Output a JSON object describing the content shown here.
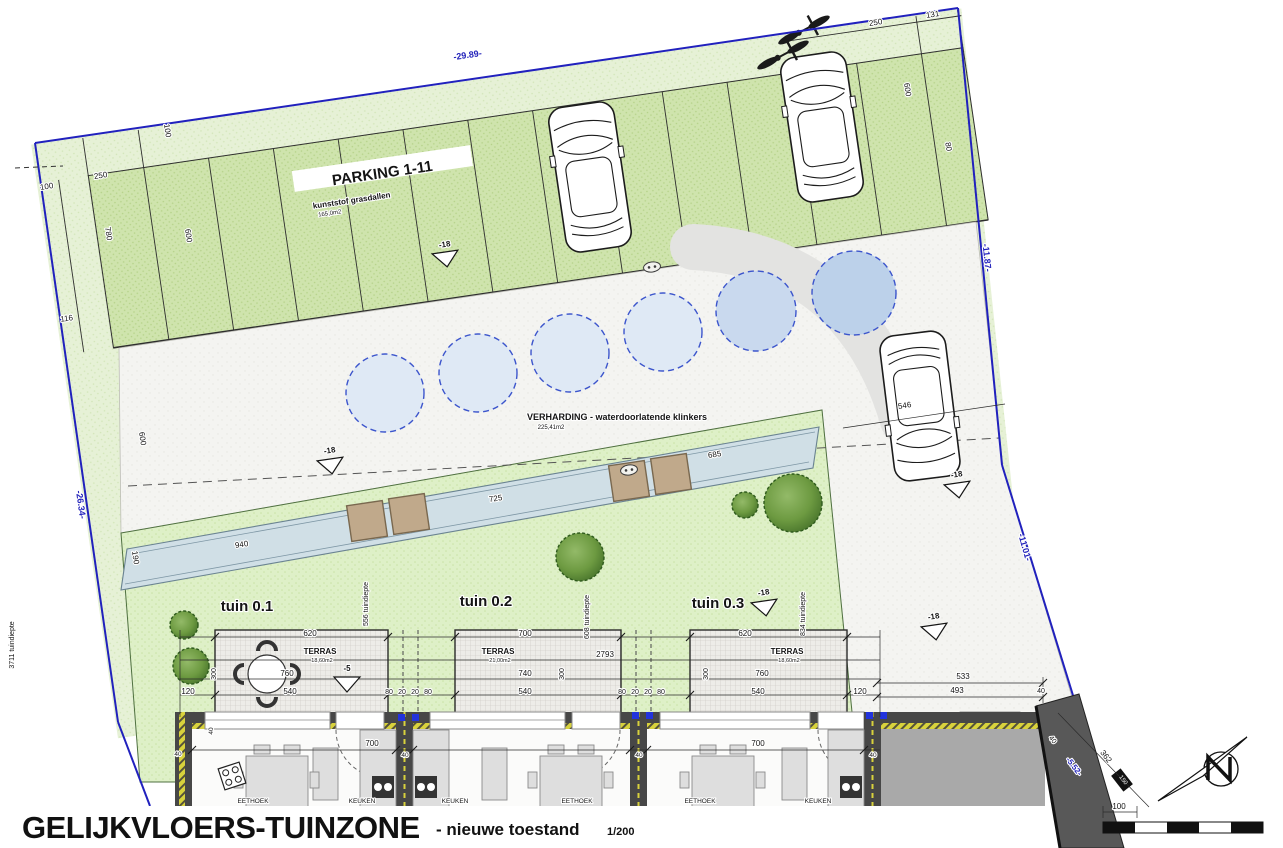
{
  "meta": {
    "drawing_title": "GELIJKVLOERS-TUINZONE",
    "subtitle": "- nieuwe toestand",
    "scale": "1/200"
  },
  "site": {
    "parking": {
      "label": "PARKING 1-11",
      "material": "kunststof grasdallen",
      "area": "165,0m2",
      "stalls": 11
    },
    "paving": {
      "label": "VERHARDING - waterdoorlatende klinkers",
      "area": "225,41m2"
    },
    "gardens": [
      {
        "name": "tuin 0.1",
        "terrace_label": "TERRAS",
        "terrace_area": "18,60m2",
        "depth_label": "556 tuindiepte"
      },
      {
        "name": "tuin 0.2",
        "terrace_label": "TERRAS",
        "terrace_area": "21,00m2",
        "depth_label": "608 tuindiepte"
      },
      {
        "name": "tuin 0.3",
        "terrace_label": "TERRAS",
        "terrace_area": "18,60m2",
        "depth_label": "834 tuindiepte"
      }
    ],
    "left_depth_label": "3711 tuindiepte",
    "boundary_lengths": [
      "-29.89-",
      "-11.87-",
      "-11.01-",
      "-26.34-",
      "-5.52-"
    ],
    "level_markers": [
      "-18",
      "-5"
    ],
    "rooms": [
      "EETHOEK",
      "KEUKEN",
      "KEUKEN",
      "EETHOEK",
      "EETHOEK",
      "KEUKEN"
    ]
  },
  "colors": {
    "boundary_blue": "#2121bd",
    "band_green": "#e6f1d6",
    "parking_green": "#cfe4ad",
    "garden_green": "#def0c7",
    "paving_grey": "#f4f4f1",
    "channel_blue": "#d0dfe6",
    "circle_light_blue": "#dfe9f5",
    "circle_dark_blue": "#bcd1ea",
    "bridge_tan": "#c0a98b",
    "wall_grey": "#474747",
    "insulation_yellow": "#d8d23c"
  },
  "annotations": [
    {
      "t": "-29.89-",
      "x": 468,
      "y": 58,
      "r": -8.3,
      "s": 9,
      "c": "#2323bb",
      "b": 1,
      "n": "boundary-length-label"
    },
    {
      "t": "-11.87-",
      "x": 984,
      "y": 258,
      "r": 84,
      "s": 9,
      "c": "#2323bb",
      "b": 1,
      "n": "boundary-length-label"
    },
    {
      "t": "-11.01-",
      "x": 1022,
      "y": 548,
      "r": 74,
      "s": 9,
      "c": "#2323bb",
      "b": 1,
      "n": "boundary-length-label"
    },
    {
      "t": "-26.34-",
      "x": 78,
      "y": 505,
      "r": 82,
      "s": 9,
      "c": "#2323bb",
      "b": 1,
      "n": "boundary-length-label"
    },
    {
      "t": "-5.52-",
      "x": 1072,
      "y": 768,
      "r": 52,
      "s": 8,
      "c": "#2323bb",
      "b": 1,
      "n": "boundary-length-label"
    },
    {
      "t": "250",
      "x": 876,
      "y": 25,
      "r": -8.3,
      "s": 8,
      "n": "dim-label"
    },
    {
      "t": "131",
      "x": 933,
      "y": 17,
      "r": -8.3,
      "s": 8,
      "n": "dim-label"
    },
    {
      "t": "600",
      "x": 905,
      "y": 90,
      "r": 81,
      "s": 8,
      "n": "dim-label"
    },
    {
      "t": "80",
      "x": 946,
      "y": 147,
      "r": 81,
      "s": 8,
      "n": "dim-label"
    },
    {
      "t": "100",
      "x": 165,
      "y": 131,
      "r": 81,
      "s": 8,
      "n": "dim-label"
    },
    {
      "t": "100",
      "x": 47,
      "y": 189,
      "r": -8.3,
      "s": 8,
      "n": "dim-label"
    },
    {
      "t": "250",
      "x": 101,
      "y": 178,
      "r": -8.3,
      "s": 8,
      "n": "dim-label"
    },
    {
      "t": "780",
      "x": 106,
      "y": 234,
      "r": 81,
      "s": 8,
      "n": "dim-label"
    },
    {
      "t": "600",
      "x": 186,
      "y": 236,
      "r": 81,
      "s": 8,
      "n": "dim-label"
    },
    {
      "t": "116",
      "x": 67,
      "y": 321,
      "r": -8.3,
      "s": 8,
      "n": "dim-label"
    },
    {
      "t": "600",
      "x": 140,
      "y": 439,
      "r": 81,
      "s": 8,
      "n": "dim-label"
    },
    {
      "t": "190",
      "x": 133,
      "y": 558,
      "r": 81,
      "s": 8,
      "n": "dim-label"
    },
    {
      "t": "940",
      "x": 242,
      "y": 547,
      "r": -8.3,
      "s": 8,
      "n": "dim-label"
    },
    {
      "t": "725",
      "x": 496,
      "y": 501,
      "r": -8.3,
      "s": 8,
      "n": "dim-label"
    },
    {
      "t": "685",
      "x": 715,
      "y": 457,
      "r": -8.3,
      "s": 8,
      "n": "dim-label"
    },
    {
      "t": "546",
      "x": 905,
      "y": 408,
      "r": -8.3,
      "s": 8,
      "n": "dim-label"
    },
    {
      "t": "PARKING 1-11",
      "x": 383,
      "y": 178,
      "r": -8.3,
      "s": 15,
      "b": 1,
      "n": "parking-label"
    },
    {
      "t": "kunststof grasdallen",
      "x": 352,
      "y": 203,
      "r": -8.3,
      "s": 8,
      "b": 1,
      "n": "parking-material-label"
    },
    {
      "t": "165,0m2",
      "x": 330,
      "y": 215,
      "r": -8.3,
      "s": 6,
      "n": "parking-area-label"
    },
    {
      "t": "VERHARDING - waterdoorlatende klinkers",
      "x": 617,
      "y": 420,
      "r": 0,
      "s": 9,
      "b": 1,
      "n": "paving-label"
    },
    {
      "t": "225,41m2",
      "x": 551,
      "y": 429,
      "r": 0,
      "s": 6,
      "n": "paving-area-label"
    },
    {
      "t": "-18",
      "x": 445,
      "y": 247,
      "r": -8.3,
      "s": 8,
      "b": 1,
      "n": "level-label"
    },
    {
      "t": "-18",
      "x": 330,
      "y": 453,
      "r": -8.3,
      "s": 8,
      "b": 1,
      "n": "level-label"
    },
    {
      "t": "-18",
      "x": 957,
      "y": 477,
      "r": -8.3,
      "s": 8,
      "b": 1,
      "n": "level-label"
    },
    {
      "t": "-18",
      "x": 764,
      "y": 595,
      "r": -8.3,
      "s": 8,
      "b": 1,
      "n": "level-label"
    },
    {
      "t": "-18",
      "x": 934,
      "y": 619,
      "r": -8.3,
      "s": 8,
      "b": 1,
      "n": "level-label"
    },
    {
      "t": "-5",
      "x": 347,
      "y": 671,
      "r": 0,
      "s": 8,
      "b": 1,
      "n": "level-label"
    },
    {
      "t": "tuin 0.1",
      "x": 247,
      "y": 611,
      "r": 0,
      "s": 15,
      "b": 1,
      "n": "garden-name"
    },
    {
      "t": "tuin 0.2",
      "x": 486,
      "y": 606,
      "r": 0,
      "s": 15,
      "b": 1,
      "n": "garden-name"
    },
    {
      "t": "tuin 0.3",
      "x": 718,
      "y": 608,
      "r": 0,
      "s": 15,
      "b": 1,
      "n": "garden-name"
    },
    {
      "t": "TERRAS",
      "x": 320,
      "y": 654,
      "r": 0,
      "s": 8,
      "b": 1,
      "n": "terrace-label"
    },
    {
      "t": "18,60m2",
      "x": 322,
      "y": 662,
      "r": 0,
      "s": 5.5,
      "n": "terrace-area-label"
    },
    {
      "t": "TERRAS",
      "x": 498,
      "y": 654,
      "r": 0,
      "s": 8,
      "b": 1,
      "n": "terrace-label"
    },
    {
      "t": "21,00m2",
      "x": 500,
      "y": 662,
      "r": 0,
      "s": 5.5,
      "n": "terrace-area-label"
    },
    {
      "t": "TERRAS",
      "x": 787,
      "y": 654,
      "r": 0,
      "s": 8,
      "b": 1,
      "n": "terrace-label"
    },
    {
      "t": "18,60m2",
      "x": 789,
      "y": 662,
      "r": 0,
      "s": 5.5,
      "n": "terrace-area-label"
    },
    {
      "t": "3711 tuindiepte",
      "x": 14,
      "y": 645,
      "r": -90,
      "s": 7,
      "n": "garden-depth-label"
    },
    {
      "t": "556 tuindiepte",
      "x": 368,
      "y": 604,
      "r": -90,
      "s": 7,
      "n": "garden-depth-label"
    },
    {
      "t": "608 tuindiepte",
      "x": 589,
      "y": 617,
      "r": -90,
      "s": 7,
      "n": "garden-depth-label"
    },
    {
      "t": "834 tuindiepte",
      "x": 805,
      "y": 614,
      "r": -90,
      "s": 7,
      "n": "garden-depth-label"
    },
    {
      "t": "620",
      "x": 310,
      "y": 636,
      "n": "dim-label"
    },
    {
      "t": "700",
      "x": 525,
      "y": 636,
      "n": "dim-label"
    },
    {
      "t": "620",
      "x": 745,
      "y": 636,
      "n": "dim-label"
    },
    {
      "t": "760",
      "x": 287,
      "y": 676,
      "n": "dim-label"
    },
    {
      "t": "740",
      "x": 525,
      "y": 676,
      "n": "dim-label"
    },
    {
      "t": "760",
      "x": 762,
      "y": 676,
      "n": "dim-label"
    },
    {
      "t": "540",
      "x": 290,
      "y": 694,
      "n": "dim-label"
    },
    {
      "t": "540",
      "x": 525,
      "y": 694,
      "n": "dim-label"
    },
    {
      "t": "540",
      "x": 758,
      "y": 694,
      "n": "dim-label"
    },
    {
      "t": "120",
      "x": 188,
      "y": 694,
      "n": "dim-label"
    },
    {
      "t": "120",
      "x": 860,
      "y": 694,
      "n": "dim-label"
    },
    {
      "t": "2793",
      "x": 605,
      "y": 657,
      "n": "dim-label"
    },
    {
      "t": "300",
      "x": 216,
      "y": 674,
      "r": -90,
      "s": 7,
      "n": "dim-label"
    },
    {
      "t": "300",
      "x": 564,
      "y": 674,
      "r": -90,
      "s": 7,
      "n": "dim-label"
    },
    {
      "t": "300",
      "x": 708,
      "y": 674,
      "r": -90,
      "s": 7,
      "n": "dim-label"
    },
    {
      "t": "80",
      "x": 389,
      "y": 694,
      "s": 7,
      "n": "dim-label"
    },
    {
      "t": "20",
      "x": 402,
      "y": 694,
      "s": 7,
      "n": "dim-label"
    },
    {
      "t": "20",
      "x": 415,
      "y": 694,
      "s": 7,
      "n": "dim-label"
    },
    {
      "t": "80",
      "x": 428,
      "y": 694,
      "s": 7,
      "n": "dim-label"
    },
    {
      "t": "80",
      "x": 622,
      "y": 694,
      "s": 7,
      "n": "dim-label"
    },
    {
      "t": "20",
      "x": 635,
      "y": 694,
      "s": 7,
      "n": "dim-label"
    },
    {
      "t": "20",
      "x": 648,
      "y": 694,
      "s": 7,
      "n": "dim-label"
    },
    {
      "t": "80",
      "x": 661,
      "y": 694,
      "s": 7,
      "n": "dim-label"
    },
    {
      "t": "533",
      "x": 963,
      "y": 679,
      "n": "dim-label"
    },
    {
      "t": "493",
      "x": 957,
      "y": 693,
      "n": "dim-label"
    },
    {
      "t": "40",
      "x": 1041,
      "y": 693,
      "s": 7,
      "n": "dim-label"
    },
    {
      "t": "700",
      "x": 372,
      "y": 746,
      "n": "dim-label"
    },
    {
      "t": "700",
      "x": 758,
      "y": 746,
      "n": "dim-label"
    },
    {
      "t": "40",
      "x": 178,
      "y": 756,
      "s": 6.5,
      "n": "dim-label"
    },
    {
      "t": "40",
      "x": 213,
      "y": 731,
      "r": -90,
      "s": 6.5,
      "n": "dim-label"
    },
    {
      "t": "40",
      "x": 405,
      "y": 757,
      "s": 6.5,
      "n": "dim-label"
    },
    {
      "t": "40",
      "x": 639,
      "y": 757,
      "s": 6.5,
      "n": "dim-label"
    },
    {
      "t": "40",
      "x": 873,
      "y": 757,
      "s": 6.5,
      "n": "dim-label"
    },
    {
      "t": "362",
      "x": 1104,
      "y": 758,
      "r": 52,
      "s": 8,
      "n": "dim-label"
    },
    {
      "t": "100",
      "x": 1119,
      "y": 809,
      "r": 0,
      "s": 8,
      "n": "dim-label"
    },
    {
      "t": "40",
      "x": 1051,
      "y": 741,
      "r": 52,
      "s": 7,
      "n": "dim-label"
    },
    {
      "t": "150",
      "x": 1122,
      "y": 781,
      "r": 52,
      "s": 6,
      "c": "#ffffff",
      "hl": 0,
      "n": "dim-label"
    },
    {
      "t": "EETHOEK",
      "x": 253,
      "y": 803,
      "s": 6.5,
      "n": "room-label"
    },
    {
      "t": "KEUKEN",
      "x": 362,
      "y": 803,
      "s": 6.5,
      "n": "room-label"
    },
    {
      "t": "KEUKEN",
      "x": 455,
      "y": 803,
      "s": 6.5,
      "n": "room-label"
    },
    {
      "t": "EETHOEK",
      "x": 577,
      "y": 803,
      "s": 6.5,
      "n": "room-label"
    },
    {
      "t": "EETHOEK",
      "x": 700,
      "y": 803,
      "s": 6.5,
      "n": "room-label"
    },
    {
      "t": "KEUKEN",
      "x": 818,
      "y": 803,
      "s": 6.5,
      "n": "room-label"
    }
  ]
}
